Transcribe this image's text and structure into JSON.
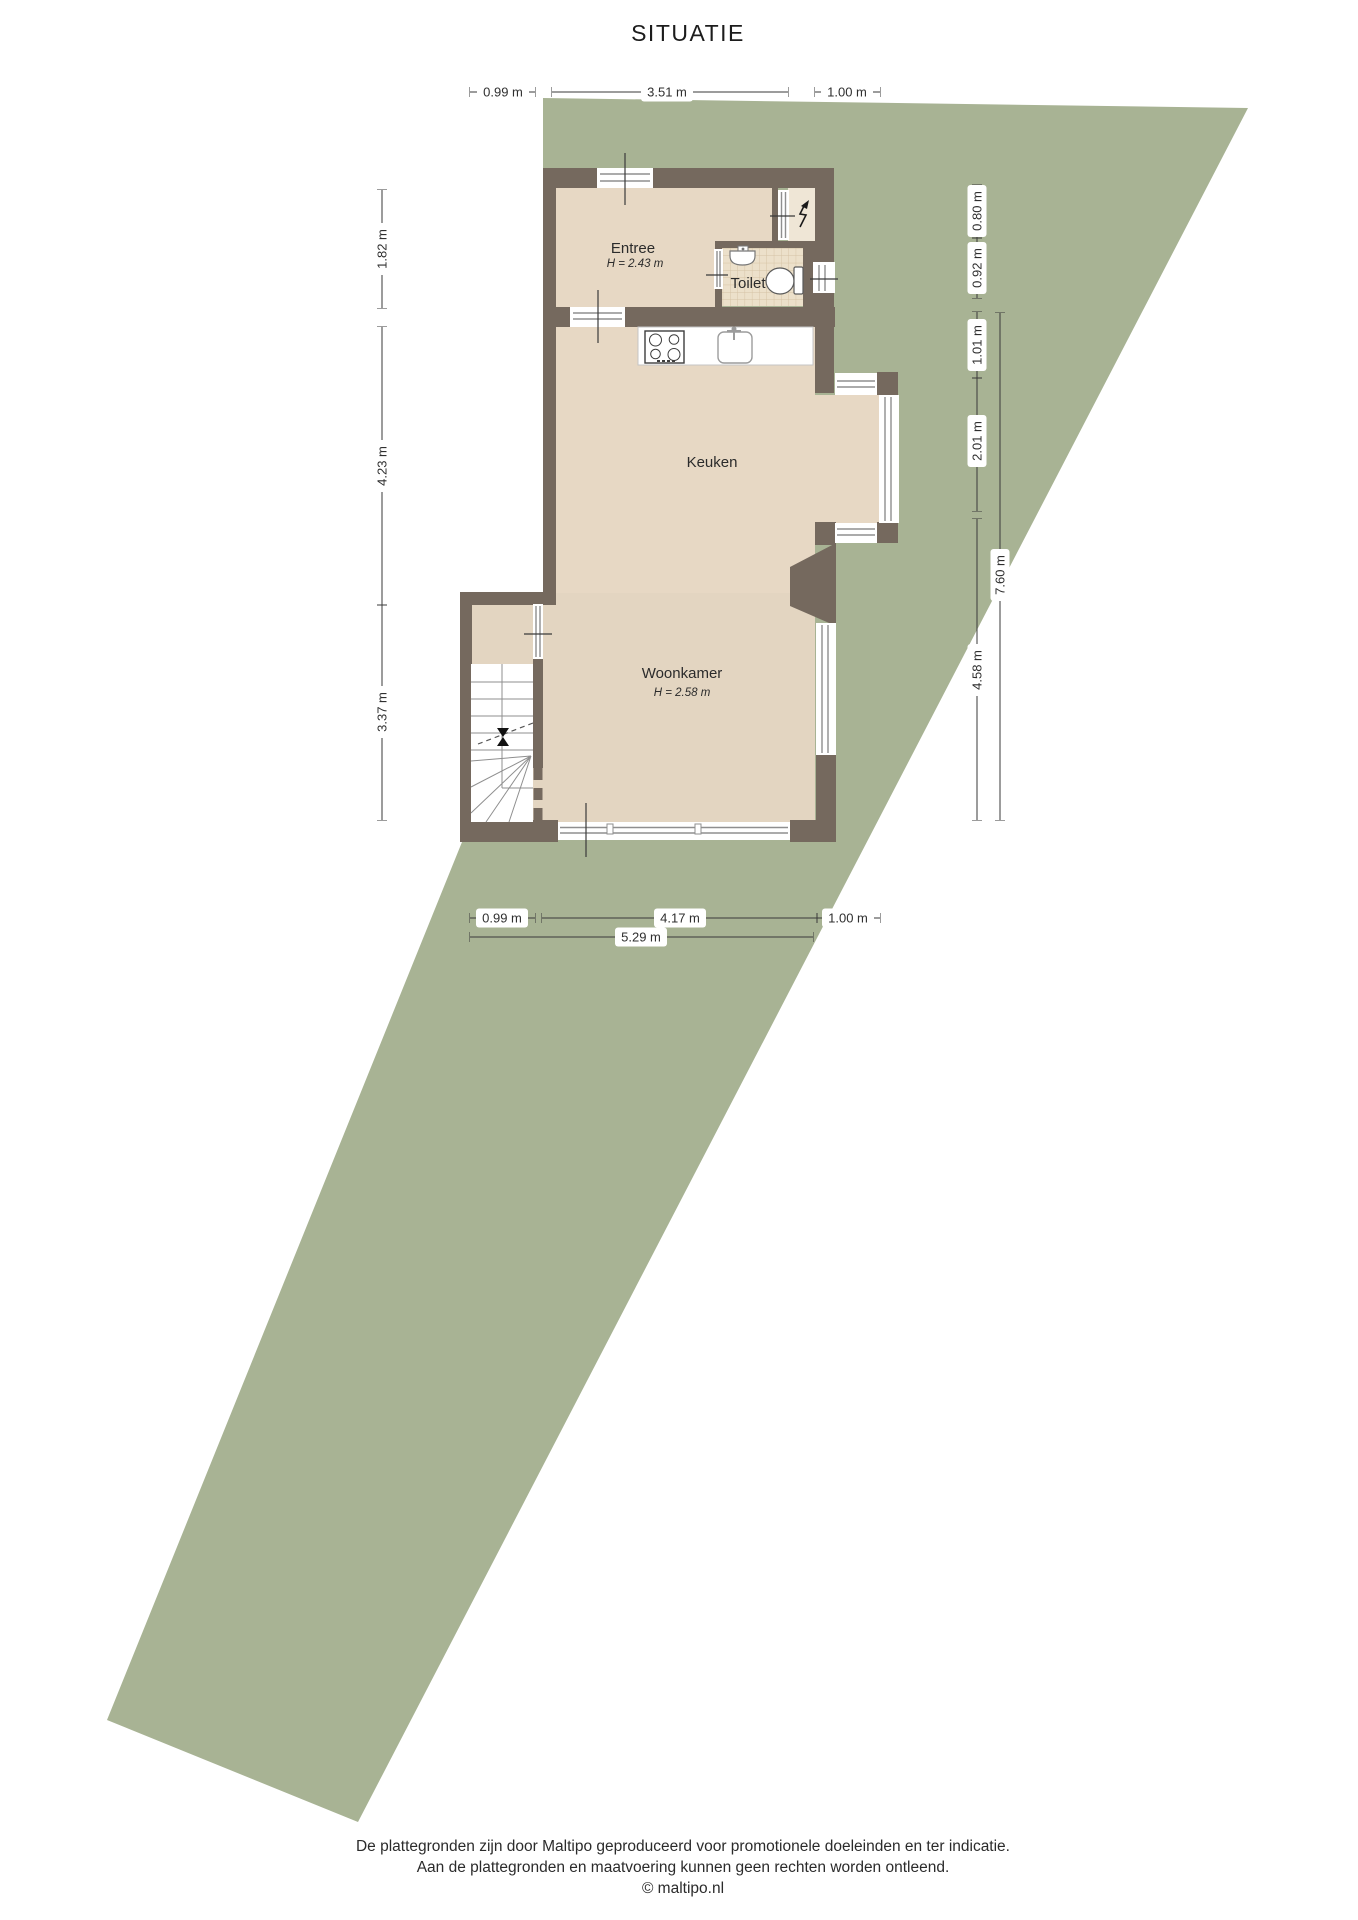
{
  "title": "SITUATIE",
  "rooms": {
    "entree": {
      "name": "Entree",
      "height": "H = 2.43 m"
    },
    "toilet": {
      "name": "Toilet"
    },
    "keuken": {
      "name": "Keuken"
    },
    "woonkamer": {
      "name": "Woonkamer",
      "height": "H = 2.58 m"
    }
  },
  "dimensions": {
    "top": [
      "0.99 m",
      "3.51 m",
      "1.00 m"
    ],
    "left": [
      "1.82 m",
      "4.23 m",
      "3.37 m"
    ],
    "right": [
      "0.80 m",
      "0.92 m",
      "1.01 m",
      "2.01 m",
      "4.58 m",
      "7.60 m"
    ],
    "bottom": [
      "0.99 m",
      "4.17 m",
      "1.00 m",
      "5.29 m"
    ]
  },
  "footer": {
    "line1": "De plattegronden zijn door Maltipo geproduceerd voor promotionele doeleinden en ter indicatie.",
    "line2": "Aan de plattegronden en maatvoering kunnen geen rechten worden ontleend.",
    "line3": "© maltipo.nl"
  },
  "colors": {
    "plot_green": "#a8b394",
    "wall": "#75695e",
    "floor": "#e7d8c4",
    "floor_woonkamer": "#e3d5c1",
    "floor_toilet": "#ece0ca",
    "floor_meterkast": "#efe6d6"
  }
}
